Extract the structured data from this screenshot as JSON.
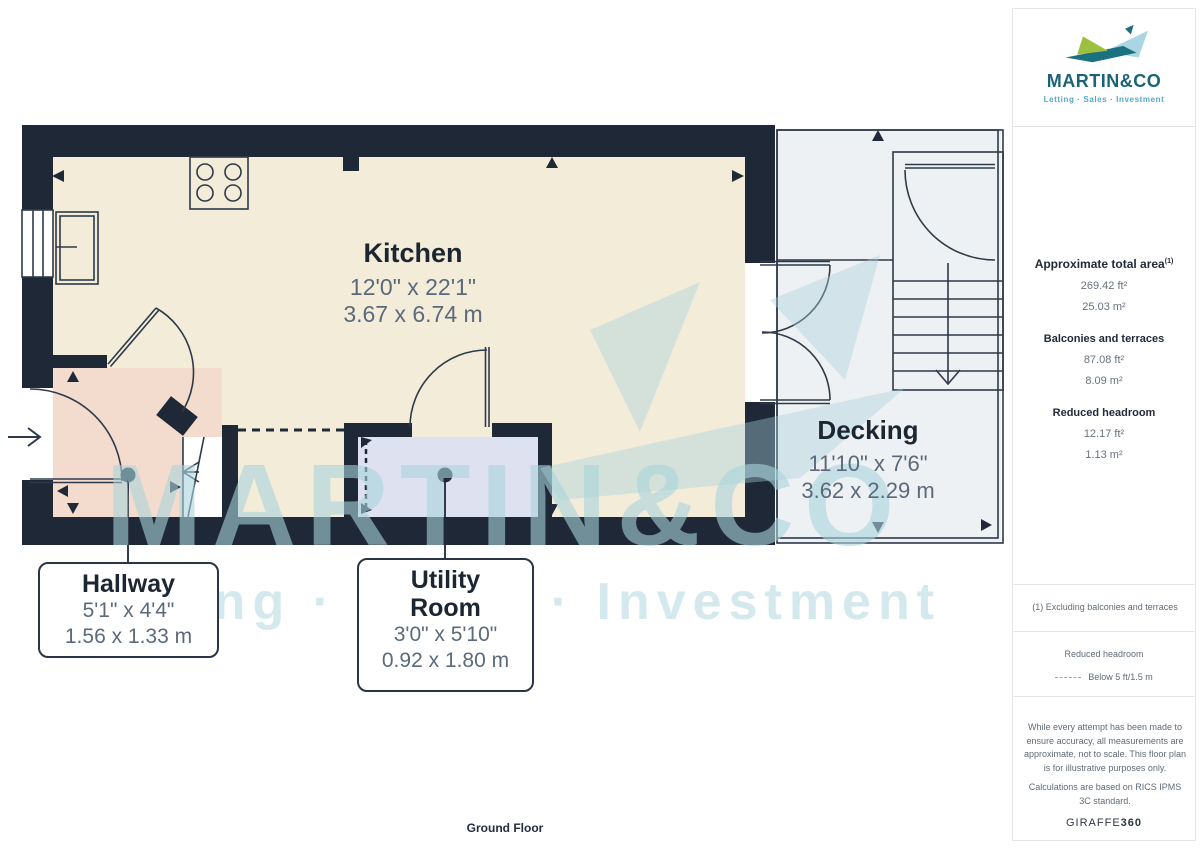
{
  "plan": {
    "rooms": {
      "kitchen": {
        "name": "Kitchen",
        "dim_imperial": "12'0\" x 22'1\"",
        "dim_metric": "3.67 x 6.74 m"
      },
      "decking": {
        "name": "Decking",
        "dim_imperial": "11'10\" x 7'6\"",
        "dim_metric": "3.62 x 2.29 m"
      },
      "hallway": {
        "name": "Hallway",
        "dim_imperial": "5'1\" x 4'4\"",
        "dim_metric": "1.56 x 1.33 m"
      },
      "utility": {
        "name": "Utility Room",
        "dim_imperial": "3'0\" x 5'10\"",
        "dim_metric": "0.92 x 1.80 m"
      }
    },
    "floor_label": "Ground Floor",
    "watermark": {
      "line1": "MARTIN&CO",
      "line2": "Letting · Sales · Investment"
    }
  },
  "sidebar": {
    "logo": {
      "brand": "MARTIN&CO",
      "tagline": "Letting · Sales · Investment"
    },
    "areas": {
      "total": {
        "label": "Approximate total area",
        "sup": "(1)",
        "ft": "269.42 ft²",
        "m": "25.03 m²"
      },
      "balconies": {
        "label": "Balconies and terraces",
        "ft": "87.08 ft²",
        "m": "8.09 m²"
      },
      "reduced": {
        "label": "Reduced headroom",
        "ft": "12.17 ft²",
        "m": "1.13 m²"
      }
    },
    "note": "(1) Excluding balconies and terraces",
    "legend": {
      "title": "Reduced headroom",
      "item": "Below 5 ft/1.5 m"
    },
    "disclaimer1": "While every attempt has been made to ensure accuracy, all measurements are approximate, not to scale. This floor plan is for illustrative purposes only.",
    "disclaimer2": "Calculations are based on RICS IPMS 3C standard.",
    "brand_footer": {
      "name": "GIRAFFE",
      "suffix": "360"
    }
  },
  "colors": {
    "wall": "#1e2836",
    "kitchen_floor": "#f2ecd9",
    "hallway_floor": "#f3dbcd",
    "utility_floor": "#dee2f0",
    "decking_floor": "#eef1f3",
    "brand_teal": "#1b6376",
    "brand_light_blue": "#55a8c5",
    "brand_green": "#9dc13f",
    "dim_text": "#5b6a7b",
    "watermark": "#a8d3dc"
  }
}
